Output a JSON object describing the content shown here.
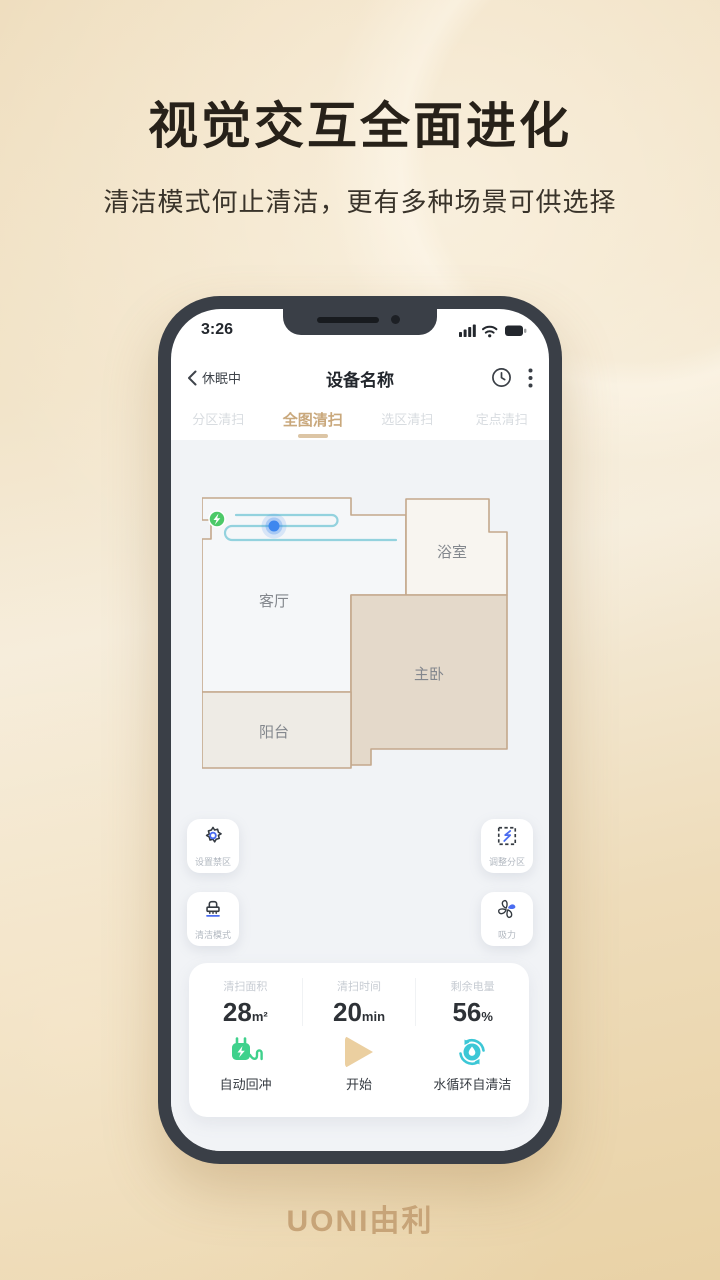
{
  "hero": {
    "title": "视觉交互全面进化",
    "subtitle": "清洁模式何止清洁，更有多种场景可供选择"
  },
  "phone": {
    "status_bar": {
      "time": "3:26",
      "icons": [
        "signal-bars-icon",
        "wifi-icon",
        "battery-icon"
      ]
    },
    "nav": {
      "back_label": "休眠中",
      "title": "设备名称",
      "right_icons": [
        "history-clock-icon",
        "more-kebab-icon"
      ]
    },
    "tabs": [
      {
        "label": "分区清扫",
        "active": false
      },
      {
        "label": "全图清扫",
        "active": true
      },
      {
        "label": "选区清扫",
        "active": false
      },
      {
        "label": "定点清扫",
        "active": false
      }
    ],
    "map": {
      "rooms": [
        {
          "name": "客厅"
        },
        {
          "name": "浴室"
        },
        {
          "name": "主卧"
        },
        {
          "name": "阳台"
        }
      ],
      "markers": [
        "charging-dock-icon",
        "robot-position-icon",
        "cleaning-path"
      ]
    },
    "map_buttons": [
      {
        "label": "设置禁区",
        "icon": "gear-icon"
      },
      {
        "label": "调整分区",
        "icon": "partition-icon"
      },
      {
        "label": "清洁模式",
        "icon": "brush-icon"
      },
      {
        "label": "吸力",
        "icon": "fan-icon"
      }
    ],
    "stats": {
      "items": [
        {
          "label": "清扫面积",
          "value": "28",
          "unit": "m²"
        },
        {
          "label": "清扫时间",
          "value": "20",
          "unit": "min"
        },
        {
          "label": "剩余电量",
          "value": "56",
          "unit": "%"
        }
      ]
    },
    "actions": [
      {
        "label": "自动回冲",
        "icon": "charge-plug-icon"
      },
      {
        "label": "开始",
        "icon": "play-icon"
      },
      {
        "label": "水循环自清洁",
        "icon": "self-clean-icon"
      }
    ]
  },
  "footer": {
    "logo": "UONI由利"
  },
  "colors": {
    "accent_gold": "#c9a87c",
    "robot_blue": "#3d87ef",
    "dock_green": "#4cc968",
    "action_green": "#3fd18c",
    "action_teal": "#3cc7d6",
    "play_tan": "#ebcfa0",
    "room_tan": "#e4d9ca",
    "frame_dark": "#3a3f47"
  }
}
